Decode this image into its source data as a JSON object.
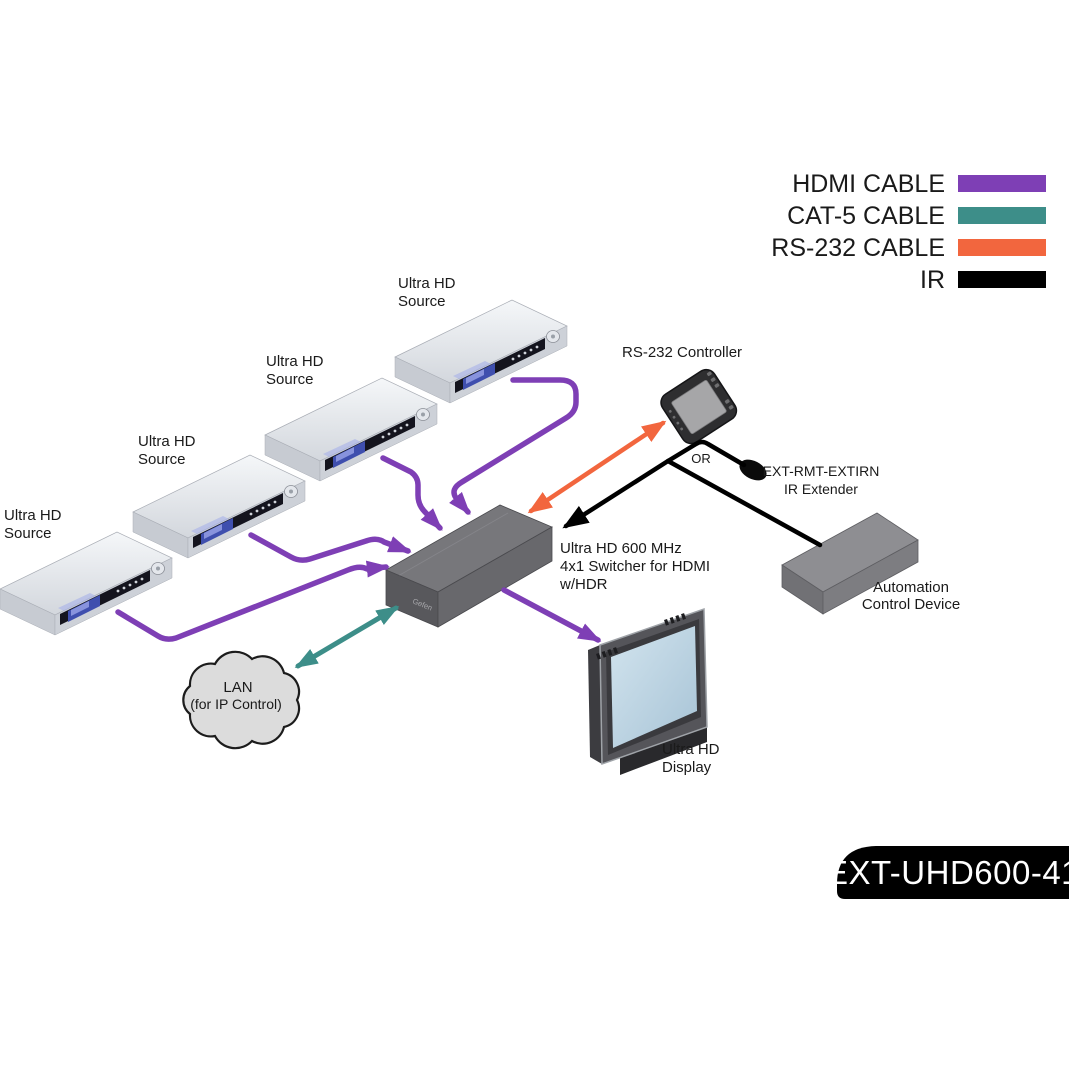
{
  "legend": {
    "items": [
      {
        "label": "HDMI CABLE",
        "color": "#7E3FB5"
      },
      {
        "label": "CAT-5 CABLE",
        "color": "#3D8E89"
      },
      {
        "label": "RS-232 CABLE",
        "color": "#F2663E"
      },
      {
        "label": "IR",
        "color": "#000000"
      }
    ]
  },
  "colors": {
    "hdmi": "#7E3FB5",
    "cat5": "#3D8E89",
    "rs232": "#F2663E",
    "ir": "#000000"
  },
  "sources": [
    {
      "line1": "Ultra HD",
      "line2": "Source"
    },
    {
      "line1": "Ultra HD",
      "line2": "Source"
    },
    {
      "line1": "Ultra HD",
      "line2": "Source"
    },
    {
      "line1": "Ultra HD",
      "line2": "Source"
    }
  ],
  "switcher": {
    "line1": "Ultra HD 600 MHz",
    "line2": "4x1 Switcher for HDMI",
    "line3": "w/HDR",
    "logo": "Gefen"
  },
  "controller": {
    "label": "RS-232 Controller"
  },
  "ir_extender": {
    "line1": "EXT-RMT-EXTIRN",
    "line2": "IR Extender",
    "or_label": "OR"
  },
  "automation": {
    "line1": "Automation",
    "line2": "Control Device"
  },
  "lan": {
    "line1": "LAN",
    "line2": "(for IP Control)"
  },
  "display": {
    "line1": "Ultra HD",
    "line2": "Display"
  },
  "badge": {
    "text": "EXT-UHD600-41"
  }
}
